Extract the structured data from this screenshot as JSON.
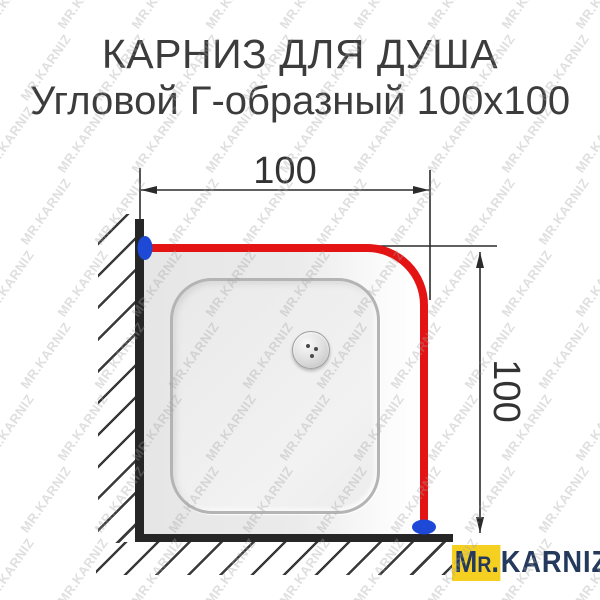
{
  "title": {
    "line1": "КАРНИЗ ДЛЯ ДУША",
    "line2": "Угловой Г-образный 100х100"
  },
  "diagram": {
    "type": "technical-dimension-drawing",
    "subject": "corner L-shaped shower curtain rod over square shower tray",
    "width_dimension": "100",
    "height_dimension": "100"
  },
  "watermark": {
    "text": "MR.KARNIZ"
  },
  "logo": {
    "prefix": "Mr.",
    "name": "KARNIZ"
  },
  "colors": {
    "rod-red": "#e41414",
    "mount-blue": "#1d49d6",
    "wall-dark": "#262626",
    "dim-dark": "#2b2b2b",
    "title-gray": "#3c3c3c",
    "logo-yellow": "#f5d020",
    "logo-navy": "#25395c"
  }
}
